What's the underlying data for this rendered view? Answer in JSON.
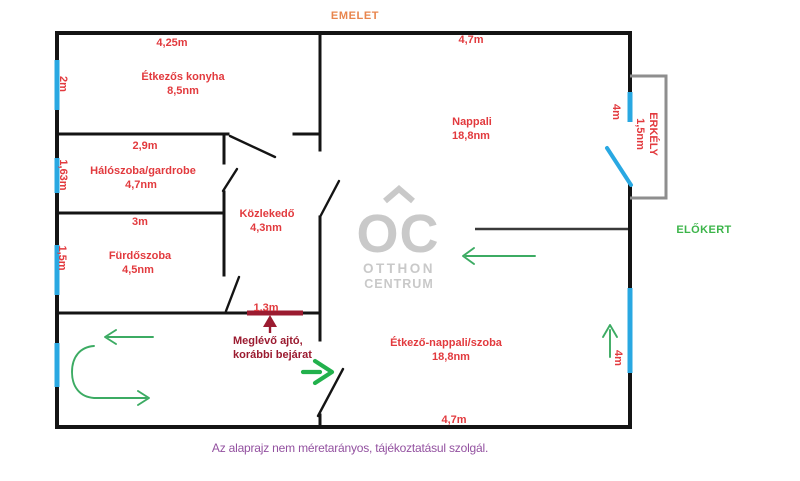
{
  "title": "EMELET",
  "outside_label": "ELŐKERT",
  "footer": "Az alaprajz nem méretarányos, tájékoztatásul szolgál.",
  "watermark": {
    "logo": "OC",
    "name1": "OTTHON",
    "name2": "CENTRUM"
  },
  "rooms": {
    "kitchen": {
      "name": "Étkezős konyha",
      "area": "8,5nm"
    },
    "bedroom": {
      "name": "Hálószoba/gardrobe",
      "area": "4,7nm"
    },
    "hall": {
      "name": "Közlekedő",
      "area": "4,3nm"
    },
    "bathroom": {
      "name": "Fürdőszoba",
      "area": "4,5nm"
    },
    "living": {
      "name": "Nappali",
      "area": "18,8nm"
    },
    "dining": {
      "name": "Étkező-nappali/szoba",
      "area": "18,8nm"
    },
    "balcony": {
      "name": "ERKÉLY",
      "area": "1,5nm"
    }
  },
  "dims": {
    "kitchen_width": "4,25m",
    "living_width": "4,7m",
    "bedroom_width": "2,9m",
    "bathroom_width": "3m",
    "dining_width": "4,7m",
    "window_kitchen": "2m",
    "window_bedroom": "1,63m",
    "window_bathroom": "1,5m",
    "window_balcony": "4m",
    "window_dining": "4m",
    "former_door_width": "1.3m"
  },
  "note": {
    "line1": "Meglévő ajtó,",
    "line2": "korábbi bejárat"
  },
  "colors": {
    "wall": "#141414",
    "window_blue": "#29a8e2",
    "label_red": "#e23a3e",
    "arrow_green": "#3cab63",
    "arrow_green_bright": "#22b14c",
    "former_door_red": "#9b1b30",
    "title_orange": "#e8854d",
    "footer_purple": "#9351a0",
    "front_garden_green": "#3cb54a",
    "watermark_gray": "#c9c9c9",
    "stair_gray": "#7a7a7a",
    "balcony_gray": "#8e8e8e"
  }
}
